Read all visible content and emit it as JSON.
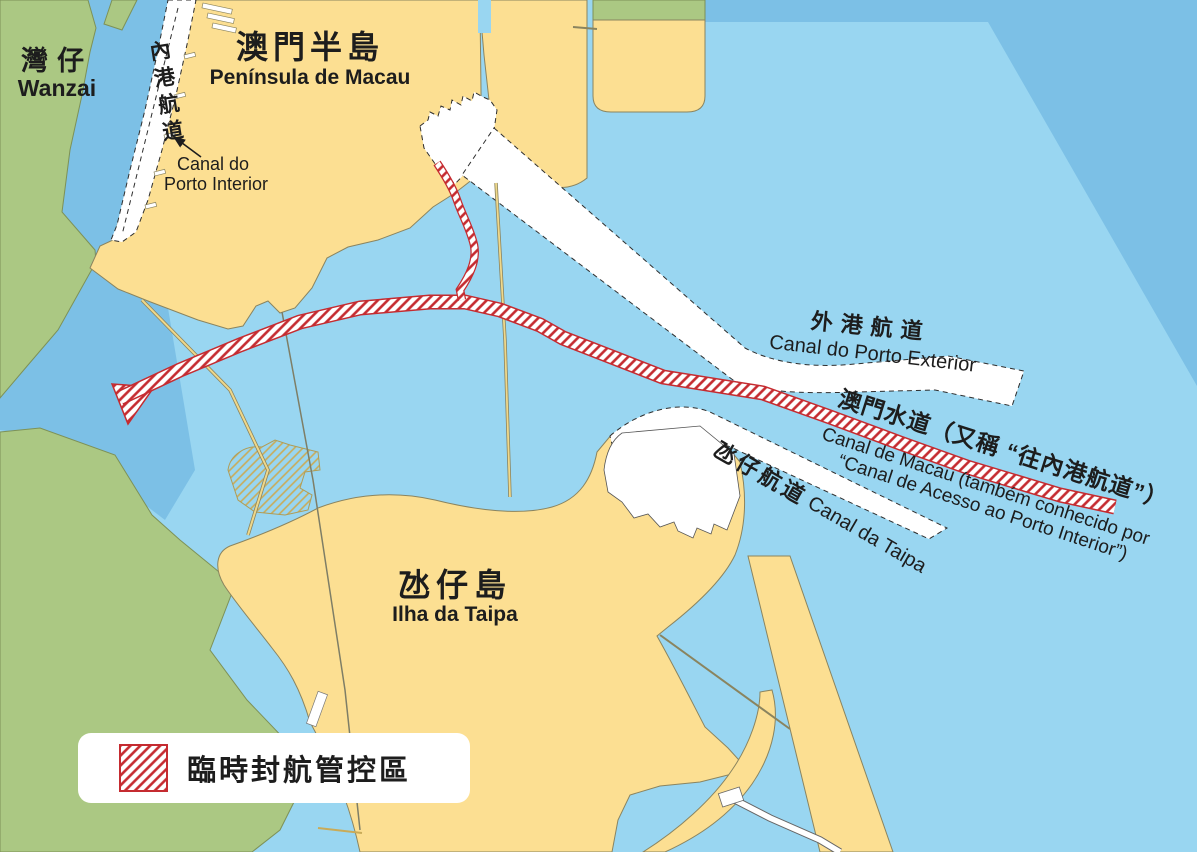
{
  "map": {
    "regions": {
      "wanzai": {
        "zh": "灣仔",
        "en": "Wanzai"
      },
      "peninsula": {
        "zh": "澳門半島",
        "pt": "Península de Macau"
      },
      "taipa_island": {
        "zh": "氹仔島",
        "pt": "Ilha da Taipa"
      }
    },
    "channels": {
      "inner_harbour": {
        "zh": "內港航道",
        "pt_line1": "Canal do",
        "pt_line2": "Porto Interior"
      },
      "outer_harbour": {
        "zh": "外港航道",
        "pt": "Canal do Porto Exterior"
      },
      "macau_waterway": {
        "zh": "澳門水道（又稱 “往內港航道”）",
        "pt_line1": "Canal de Macau (também conhecido por",
        "pt_line2": "“Canal de Acesso ao Porto Interior”)"
      },
      "taipa_channel": {
        "zh": "氹仔航道",
        "pt": "Canal da Taipa"
      }
    },
    "legend": {
      "restricted_zone": "臨時封航管控區"
    },
    "colors": {
      "water": "#99d6f1",
      "deep_water": "#7cc0e6",
      "land": "#fcdf92",
      "vegetation": "#abc883",
      "channel_white": "#ffffff",
      "restricted_red": "#c52b30"
    }
  }
}
